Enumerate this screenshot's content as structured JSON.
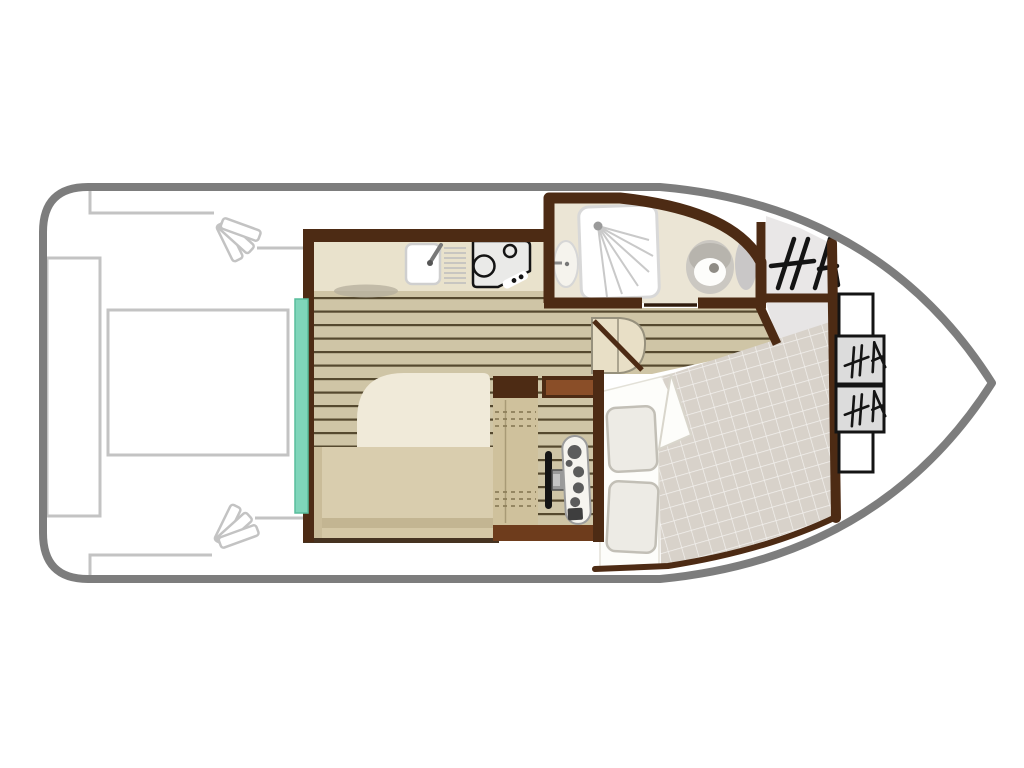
{
  "plan_title": "boat-deck-floor-plan",
  "colors": {
    "hull": "#7d7d7d",
    "outline": "#c3c3c3",
    "wall": "#4d2b14",
    "wood": "#8a4e28",
    "wood_dark": "#6e3c1c",
    "plank": "#cfc5a6",
    "plank_line": "#55492f",
    "counter": "#e9e2cc",
    "table": "#f0ead9",
    "bench": "#d9cdae",
    "bench_dark": "#c3b592",
    "bench_arm": "#cabc99",
    "seat": "#cfc19c",
    "teal": "#7fd5ba",
    "bath_floor": "#ebe5d5",
    "fixture_gray": "#cbc8c2",
    "ray_gray": "#c9c9c9",
    "tile": "#d8d2ca",
    "tile_line": "#f3f1ee",
    "landing": "#e7e5e5",
    "box_gray": "#dcdcdc",
    "ink": "#141414",
    "sheet": "#fdfdfa",
    "pillow": "#edebe5",
    "steps": "#e8dfc6",
    "console": "#f6f4ef",
    "knob": "#5c5c5c"
  },
  "parts": [
    {
      "name": "hull-outline"
    },
    {
      "name": "aft-deck"
    },
    {
      "name": "stern-bench"
    },
    {
      "name": "deck-table"
    },
    {
      "name": "boarding-steps-top"
    },
    {
      "name": "boarding-steps-bottom"
    },
    {
      "name": "saloon-galley"
    },
    {
      "name": "galley-counter"
    },
    {
      "name": "galley-sink"
    },
    {
      "name": "galley-stove"
    },
    {
      "name": "dinette-table"
    },
    {
      "name": "dinette-bench"
    },
    {
      "name": "sliding-door"
    },
    {
      "name": "helm-station"
    },
    {
      "name": "helm-seat"
    },
    {
      "name": "steering-wheel"
    },
    {
      "name": "throttle-console"
    },
    {
      "name": "storage-lockers"
    },
    {
      "name": "companionway-steps"
    },
    {
      "name": "bathroom"
    },
    {
      "name": "shower"
    },
    {
      "name": "washbasin"
    },
    {
      "name": "toilet"
    },
    {
      "name": "side-locker-steps"
    },
    {
      "name": "cabin-landing"
    },
    {
      "name": "forward-cabin"
    },
    {
      "name": "double-bed-duvet"
    },
    {
      "name": "bed-sheet-fold"
    },
    {
      "name": "pillows"
    },
    {
      "name": "bow-storage-boxes"
    }
  ]
}
